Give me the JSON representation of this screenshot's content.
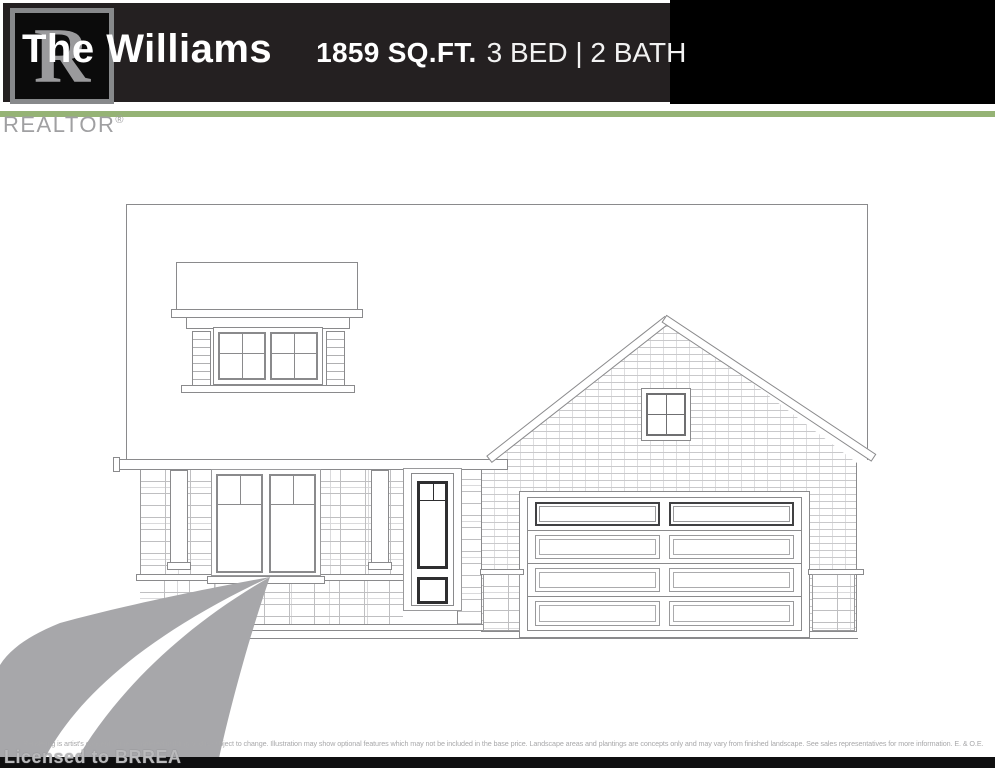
{
  "header": {
    "title": "The Williams",
    "sqft": "1859 SQ.FT.",
    "specs": "3 BED | 2 BATH",
    "bg_color": "#242021",
    "right_bg_color": "#000000",
    "accent_green": "#95b375"
  },
  "watermark": {
    "logo_letter": "R",
    "realtor": "REALTOR",
    "reg": "®",
    "licensed": "Licensed to BRREA",
    "gray": "#a7a7aa"
  },
  "drawing": {
    "line_color": "#8a8a8c",
    "elements": [
      "two-storey-left-block",
      "awning-window-with-shutters",
      "stone-main-floor",
      "double-front-window",
      "dark-front-door",
      "brick-gable",
      "gable-window",
      "double-garage-door",
      "stone-wainscot-corners"
    ]
  },
  "footer": {
    "disclaimer": "Rendering is artist's concept of the completed building and is subject to change. Illustration may show optional features which may not be included in the base price. Landscape areas and plantings are concepts only and may vary from finished landscape. See sales representatives for more information. E. & O.E."
  }
}
